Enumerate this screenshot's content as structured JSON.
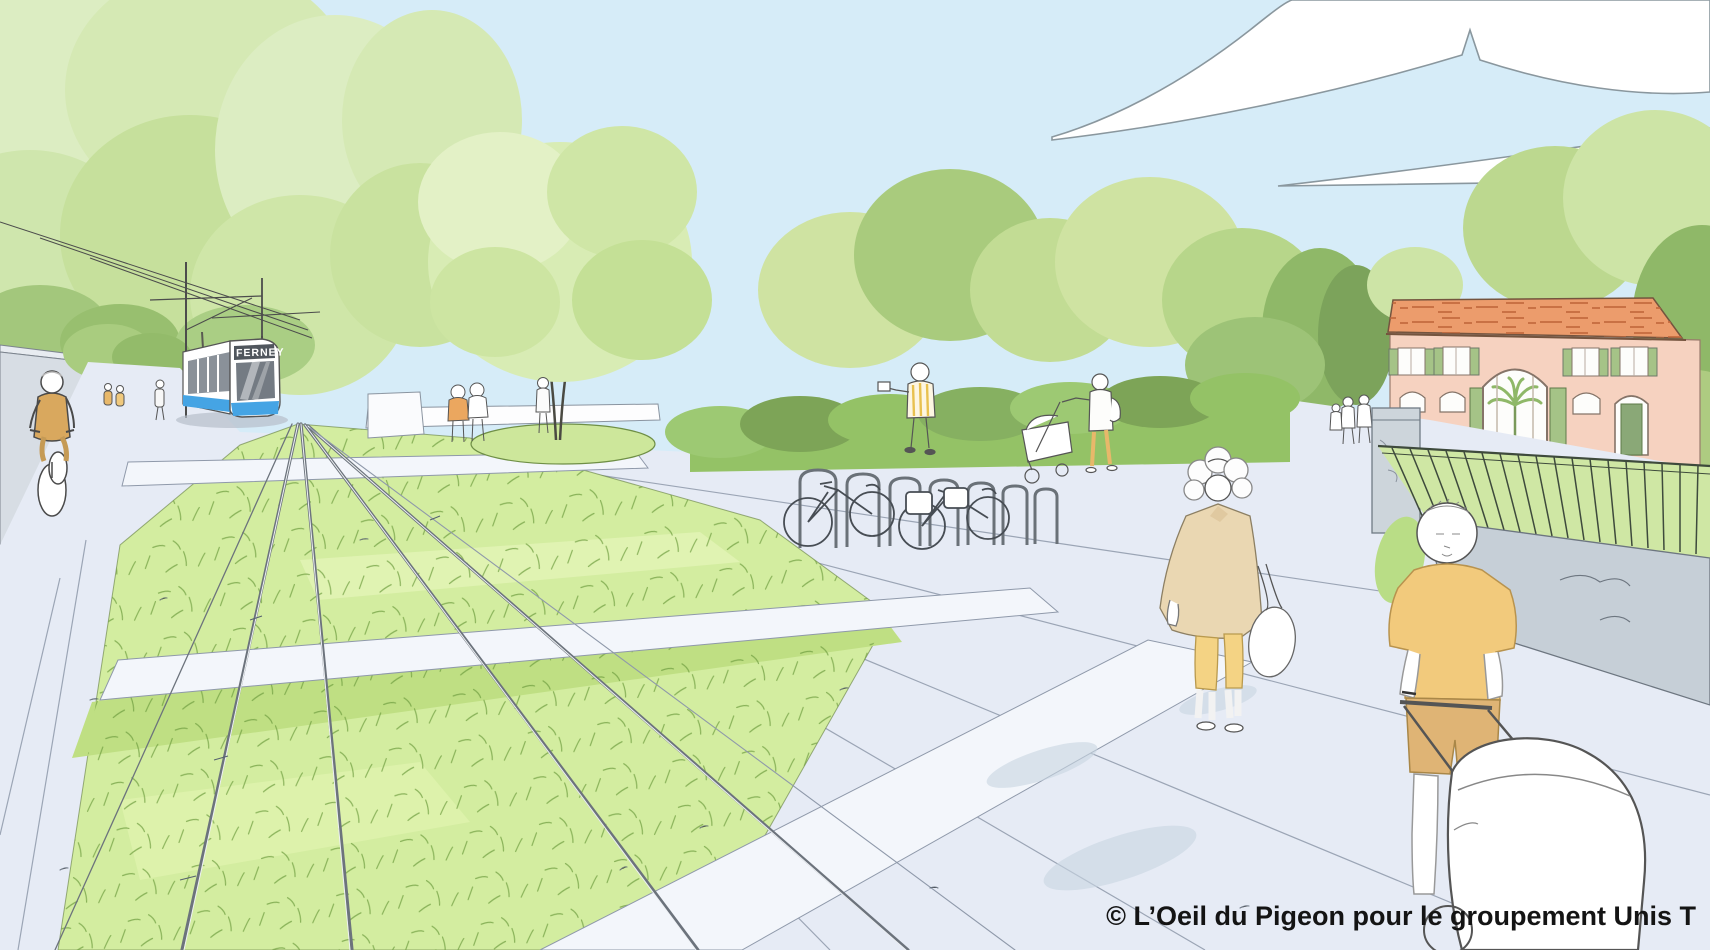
{
  "image": {
    "kind": "architectural perspective sketch of a grassed tramway public space",
    "caption": "© L’Oeil du Pigeon pour le groupement Unis T"
  },
  "tram": {
    "destination": "FERNEY",
    "body_color": "#ffffff",
    "stripe_color": "#45a4e4",
    "sign_background": "#50565d",
    "sign_text_color": "#ffffff"
  },
  "palette": {
    "sky": "#d6ecf8",
    "cloud": "#ffffff",
    "cloud_outline": "#8a979e",
    "foliage_light": "#dcedc2",
    "foliage_mid": "#c2dc94",
    "foliage_dark": "#8fb868",
    "hedge": "#94c266",
    "grass_track": "#d3eda0",
    "grass_track_shade": "#bfdf83",
    "pavement": "#e6ebf5",
    "pavement_band": "#f3f6fb",
    "sketch_line": "#4a4a4a",
    "wall_gray": "#ccd4da",
    "building_wall": "#f6d2c0",
    "building_roof": "#ec9c6c",
    "building_shutters": "#a5c387",
    "clothing_yellow": "#f2ca7c",
    "clothing_beige": "#ead7b2",
    "clothing_tan": "#d9a85e",
    "caption_color": "#141414"
  }
}
